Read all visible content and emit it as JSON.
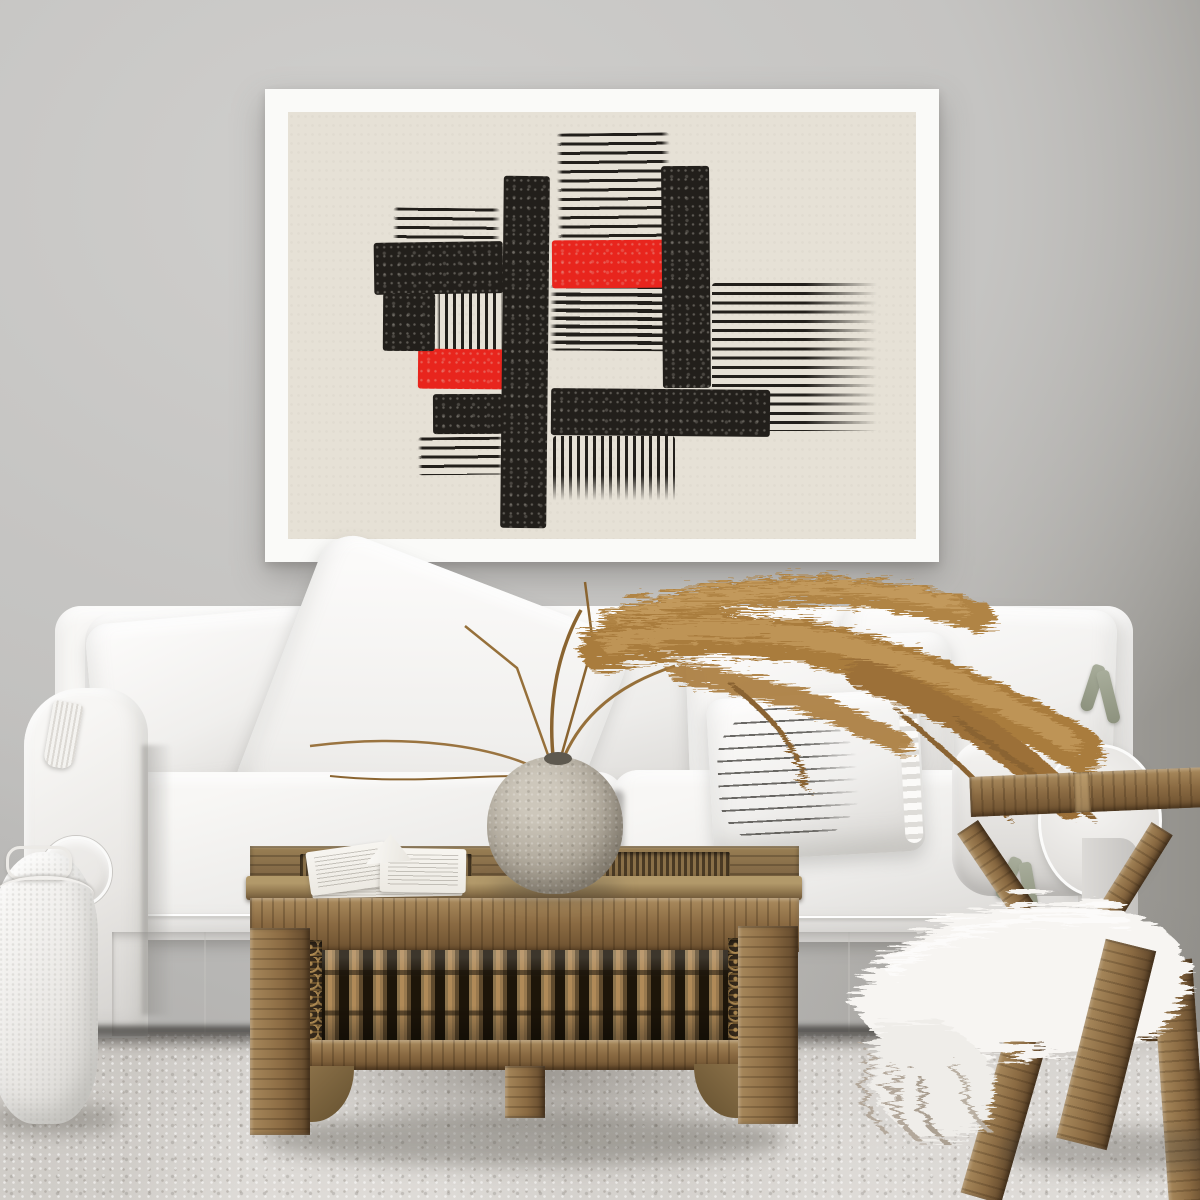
{
  "scene": {
    "type": "interior-photograph",
    "description": "Bright living room: white slipcovered sofa with white cushions and one pinstriped lumbar pillow, framed abstract black-and-red woodcut poster on a gray wall, dried pampas grass in a round stone vase and an open book on a carved Moroccan-style wooden coffee table, weathered wooden lounge chair draped with a white sheepskin throw, white knitted pouf, pale speckled carpet",
    "items": [
      {
        "name": "poster",
        "desc": "white-framed abstract linocut print, black bars and stripe blocks with two red rectangles on cream paper"
      },
      {
        "name": "sofa",
        "desc": "white slipcover sofa with scroll arm, loose cushions, tie ribbons and skirt"
      },
      {
        "name": "striped-pillow",
        "desc": "white lumbar pillow with thin dark pinstripes and ruffled flange"
      },
      {
        "name": "pampas-grass",
        "desc": "dried brown reed plumes arching right from a round vase"
      },
      {
        "name": "vase",
        "desc": "round mottled stone sphere vase"
      },
      {
        "name": "book",
        "desc": "open white book lying on table edge"
      },
      {
        "name": "coffee-table",
        "desc": "carved wood table with spindle gallery, carved corner panels and arched leg brackets"
      },
      {
        "name": "lounge-chair",
        "desc": "angular weathered wood chair with crossed frame"
      },
      {
        "name": "sheepskin",
        "desc": "white long-hair fur throw with gray tips draped over chair seat"
      },
      {
        "name": "pouf",
        "desc": "white knitted pouf with handle, bottom left corner"
      }
    ]
  },
  "colors": {
    "wall_light": "#d0cfcd",
    "wall_mid": "#c5c4c2",
    "wall_dark": "#aba9a5",
    "wall_darker": "#93918c",
    "carpet": "#d8d5d1",
    "carpet_lt": "#dedbd7",
    "carpet_shade": "#c3bfba",
    "frame": "#fafaf8",
    "paper": "#e6e1d6",
    "ink": "#221f1b",
    "accent": "#e8251d",
    "sofa_white": "#f3f2f0",
    "sofa_shade": "#d8d6d3",
    "wood_mid": "#86704e",
    "wood_dark": "#5e4b32",
    "carve_gold": "#b08a52",
    "chair_wood": "#8a6a42",
    "pampas_main": "#a97c3e",
    "pampas_light": "#c49a5c",
    "pampas_dark": "#8a6430",
    "vase_mid": "#b3ac9f",
    "fur_white": "#f6f4f1",
    "fur_gray": "#b5aca0",
    "shadow_dark": "#3f3c37"
  },
  "artwork": {
    "style": "abstract woodcut / linocut print",
    "frame": {
      "x": 265,
      "y": 89,
      "w": 674,
      "h": 473,
      "border": 23
    },
    "blocks": [
      {
        "type": "hlines",
        "x": 269,
        "y": 21,
        "w": 113,
        "h": 107,
        "rot": -0.6
      },
      {
        "type": "hlines",
        "x": 105,
        "y": 96,
        "w": 107,
        "h": 36,
        "rot": 0.5
      },
      {
        "type": "hlines",
        "x": 424,
        "y": 171,
        "w": 170,
        "h": 148,
        "fade": "right"
      },
      {
        "type": "hlines",
        "x": 262,
        "y": 173,
        "w": 132,
        "h": 66,
        "dense": true,
        "rot": 0.4
      },
      {
        "type": "hlines",
        "x": 130,
        "y": 325,
        "w": 86,
        "h": 38,
        "rot": -0.5
      },
      {
        "type": "vlines",
        "x": 149,
        "y": 178,
        "w": 66,
        "h": 61
      },
      {
        "type": "vlines",
        "x": 265,
        "y": 324,
        "w": 122,
        "h": 66,
        "fade": "bottom"
      },
      {
        "type": "red",
        "x": 264,
        "y": 128,
        "w": 115,
        "h": 48,
        "rot": -0.4
      },
      {
        "type": "red",
        "x": 130,
        "y": 237,
        "w": 86,
        "h": 40,
        "rot": 0.5
      },
      {
        "type": "black",
        "x": 86,
        "y": 130,
        "w": 129,
        "h": 52,
        "rot": -0.8
      },
      {
        "type": "black",
        "x": 95,
        "y": 181,
        "w": 52,
        "h": 58,
        "rot": 0.4
      },
      {
        "type": "black",
        "x": 145,
        "y": 282,
        "w": 70,
        "h": 40,
        "rot": -0.3
      },
      {
        "type": "black",
        "x": 263,
        "y": 277,
        "w": 219,
        "h": 47,
        "rot": 0.5
      },
      {
        "type": "black",
        "x": 214,
        "y": 64,
        "w": 46,
        "h": 352,
        "rot": 0.6
      },
      {
        "type": "black",
        "x": 374,
        "y": 54,
        "w": 48,
        "h": 222,
        "rot": -0.5
      }
    ]
  }
}
